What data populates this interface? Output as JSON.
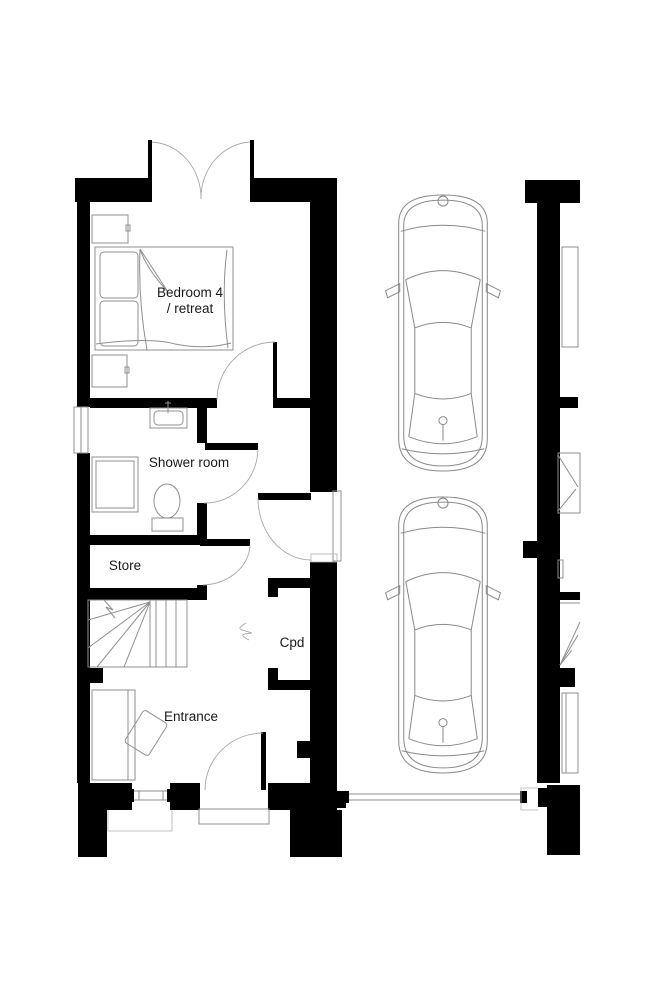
{
  "plan": {
    "background_color": "#ffffff",
    "wall_color": "#000000",
    "line_color": "#8f8f8f",
    "text_color": "#1a1a1a",
    "rooms": {
      "bedroom4": {
        "label_line1": "Bedroom 4",
        "label_line2": "/ retreat"
      },
      "shower_room": {
        "label": "Shower room"
      },
      "store": {
        "label": "Store"
      },
      "cupboard": {
        "label": "Cpd"
      },
      "entrance": {
        "label": "Entrance"
      }
    },
    "fixtures": {
      "bedroom4": [
        "double-bed",
        "bedside-table",
        "bedside-table"
      ],
      "shower_room": [
        "wash-basin",
        "toilet",
        "shower-tray"
      ],
      "hall": [
        "staircase"
      ],
      "entrance": [
        "desk",
        "chair"
      ]
    },
    "exterior": {
      "driveway_cars": 2,
      "french_doors_top": true,
      "driveway_gate": true,
      "adjacent_unit_partial": true
    }
  }
}
